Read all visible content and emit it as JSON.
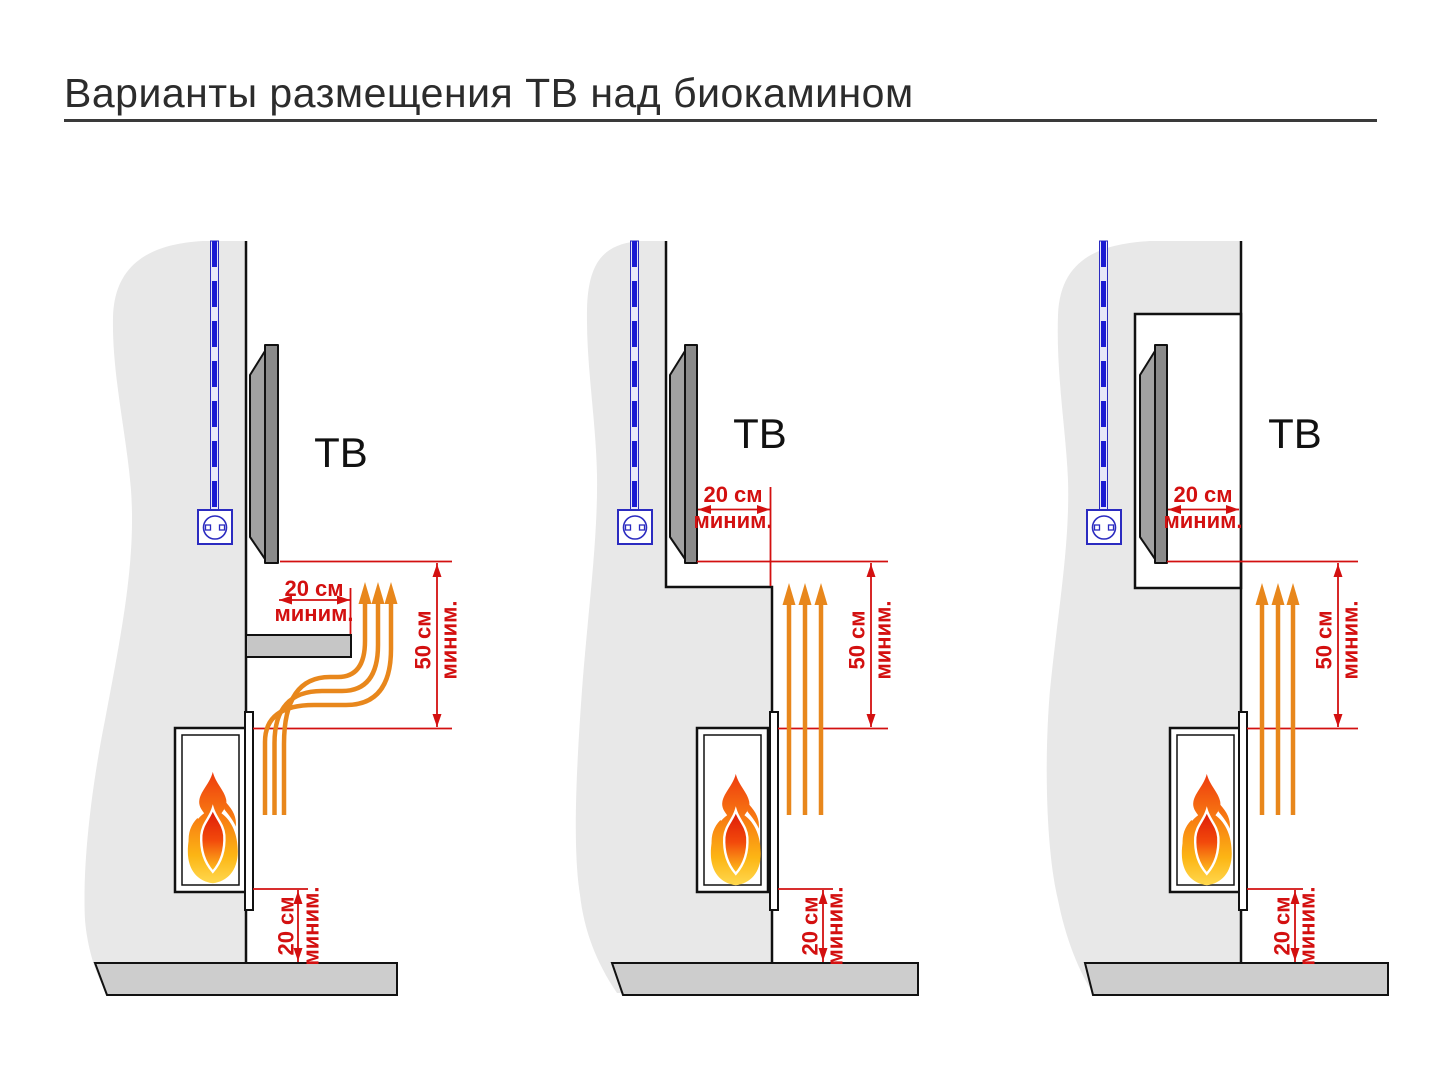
{
  "title": "Варианты размещения ТВ над биокамином",
  "colors": {
    "dimension_red": "#d31010",
    "heat_arrow_orange": "#e8871c",
    "cable_blue": "#2b2bc0",
    "wall_gray": "#e8e8e8",
    "floor_gray": "#cdcdcd"
  },
  "panels": [
    {
      "tv_label": "ТВ",
      "dim_tv_clearance": {
        "value": "20 см",
        "qualifier": "миним."
      },
      "dim_above_fireplace": {
        "value": "50 см",
        "qualifier": "миним."
      },
      "dim_floor_clearance": {
        "value": "20 см",
        "qualifier": "миним."
      }
    },
    {
      "tv_label": "ТВ",
      "dim_tv_clearance": {
        "value": "20 см",
        "qualifier": "миним."
      },
      "dim_above_fireplace": {
        "value": "50 см",
        "qualifier": "миним."
      },
      "dim_floor_clearance": {
        "value": "20 см",
        "qualifier": "миним."
      }
    },
    {
      "tv_label": "ТВ",
      "dim_tv_clearance": {
        "value": "20 см",
        "qualifier": "миним."
      },
      "dim_above_fireplace": {
        "value": "50 см",
        "qualifier": "миним."
      },
      "dim_floor_clearance": {
        "value": "20 см",
        "qualifier": "миним."
      }
    }
  ]
}
